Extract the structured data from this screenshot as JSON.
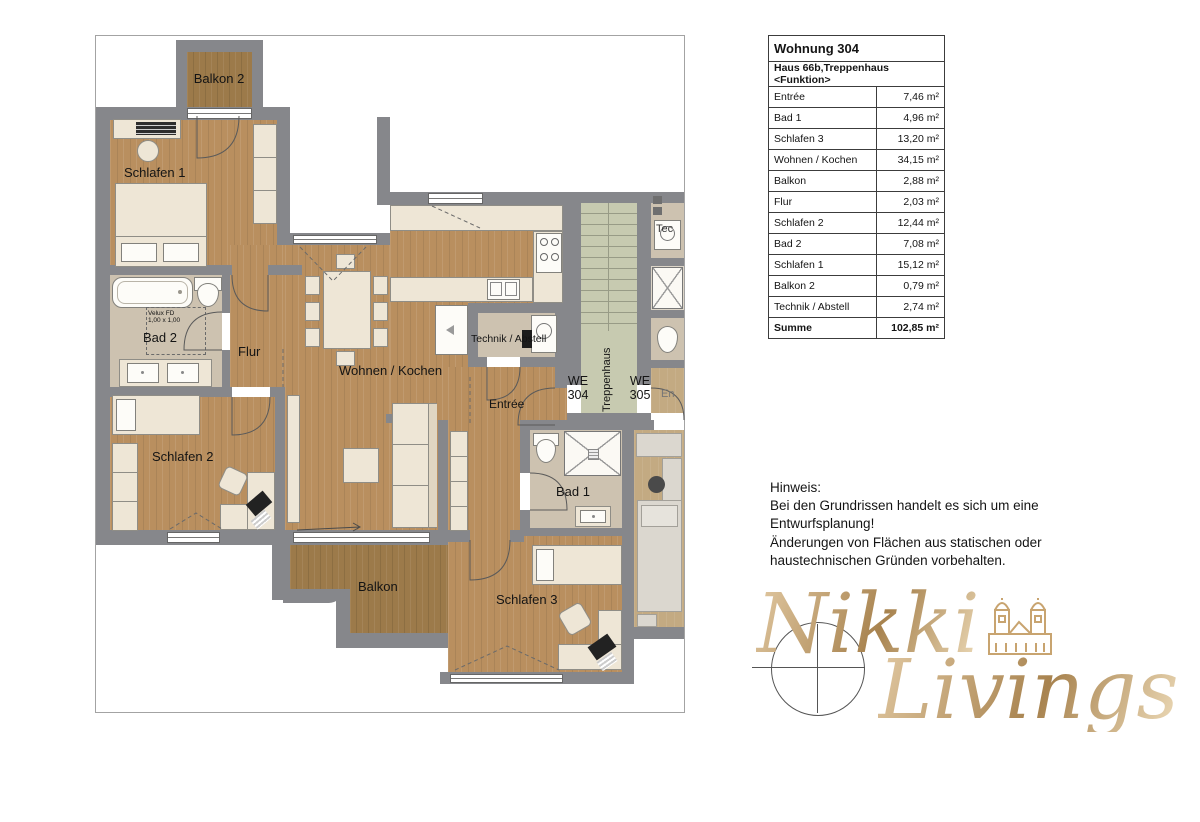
{
  "plan": {
    "labels": {
      "balkon2": "Balkon 2",
      "schlafen1": "Schlafen 1",
      "bad2": "Bad 2",
      "velux": "Velux FD\n1,00 x 1,00",
      "flur": "Flur",
      "schlafen2": "Schlafen 2",
      "wohnen": "Wohnen / Kochen",
      "technik": "Technik / Abstell",
      "entree": "Entrée",
      "we304": "WE\n304",
      "we305": "WE\n305",
      "treppenhaus": "Treppenhaus",
      "bad1": "Bad 1",
      "schlafen3": "Schlafen 3",
      "balkon": "Balkon",
      "neighbor_tech": "Tec",
      "neighbor_entree": "En"
    },
    "colors": {
      "wall": "#86878b",
      "wood_floor": "#b98f5f",
      "balcony_floor": "#9c7a4a",
      "bath_floor": "#cdc2b0",
      "stair_floor": "#c7cab0",
      "furniture": "#eee6d6",
      "logo_gold": "#c29c68"
    }
  },
  "table": {
    "title": "Wohnung 304",
    "subtitle": "Haus 66b,Treppenhaus <Funktion>",
    "rows": [
      {
        "name": "Entrée",
        "area": "7,46 m²"
      },
      {
        "name": "Bad 1",
        "area": "4,96 m²"
      },
      {
        "name": "Schlafen 3",
        "area": "13,20 m²"
      },
      {
        "name": "Wohnen / Kochen",
        "area": "34,15 m²"
      },
      {
        "name": "Balkon",
        "area": "2,88 m²"
      },
      {
        "name": "Flur",
        "area": "2,03 m²"
      },
      {
        "name": "Schlafen 2",
        "area": "12,44 m²"
      },
      {
        "name": "Bad 2",
        "area": "7,08 m²"
      },
      {
        "name": "Schlafen 1",
        "area": "15,12 m²"
      },
      {
        "name": "Balkon 2",
        "area": "0,79 m²"
      },
      {
        "name": "Technik / Abstell",
        "area": "2,74 m²"
      }
    ],
    "total": {
      "name": "Summe",
      "area": "102,85 m²"
    }
  },
  "note": {
    "line1": "Hinweis:",
    "line2": "Bei den Grundrissen handelt es sich um eine",
    "line3": "Entwurfsplanung!",
    "line4": "Änderungen von Flächen aus statischen oder",
    "line5": "haustechnischen Gründen vorbehalten."
  },
  "logo": {
    "word1": "Nikki",
    "word2": "Livings"
  }
}
